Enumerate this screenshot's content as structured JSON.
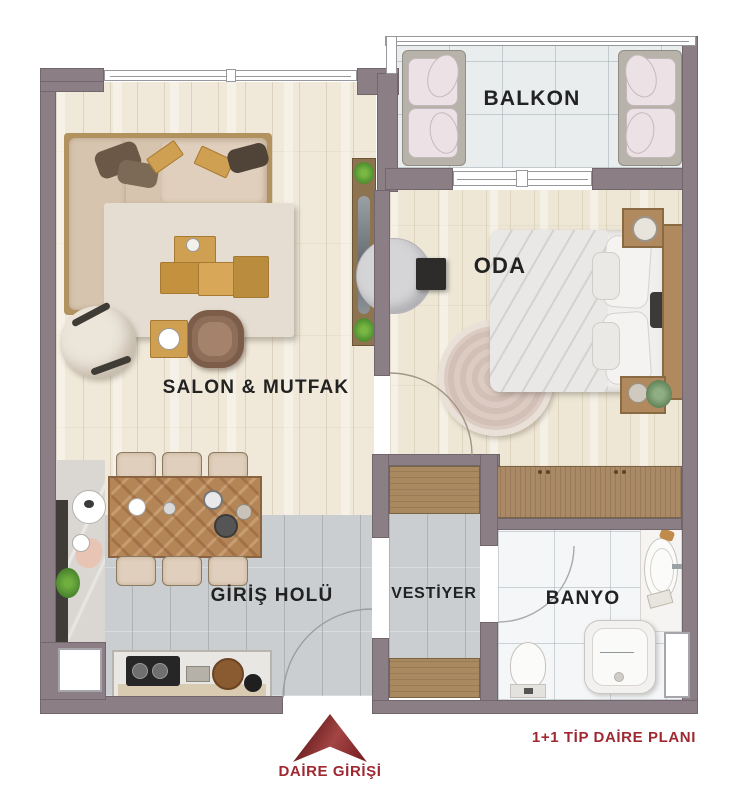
{
  "plan_title": "1+1 TİP DAİRE PLANI",
  "entrance": {
    "label": "DAİRE GİRİŞİ",
    "arrow_icon": "entrance-arrow-up"
  },
  "rooms": {
    "balkon": "BALKON",
    "oda": "ODA",
    "salon_mutfak": "SALON & MUTFAK",
    "giris_holu": "GİRİŞ HOLÜ",
    "vestiyer": "VESTİYER",
    "banyo": "BANYO"
  },
  "colors": {
    "wall": "#8b7e85",
    "accent_red": "#9f2831",
    "room_label": "#222222"
  }
}
